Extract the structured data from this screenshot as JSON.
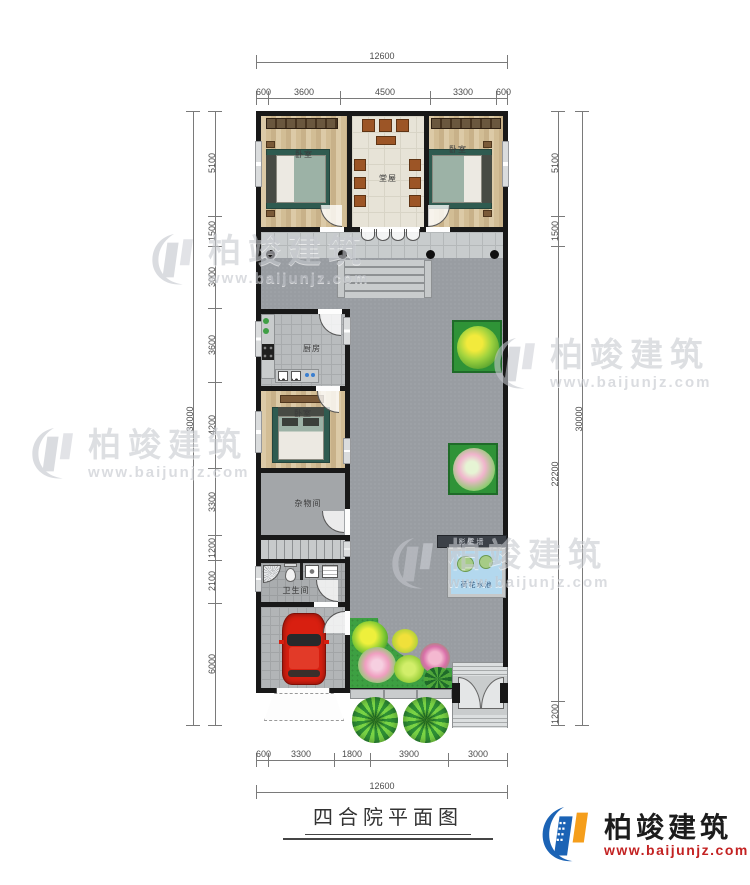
{
  "title": "四合院平面图",
  "brand": {
    "name": "柏竣建筑",
    "url": "www.baijunjz.com"
  },
  "watermark": {
    "name": "柏竣建筑",
    "url": "www.baijunjz.com"
  },
  "rooms": {
    "bedroom_top_left": "卧室",
    "hall": "堂屋",
    "bedroom_top_right": "卧室",
    "kitchen": "厨房",
    "bedroom_west": "卧室",
    "storage": "杂物间",
    "bathroom": "卫生间",
    "screen_wall": "影壁墙",
    "lotus_pond": "荷花水池"
  },
  "dimensions": {
    "top": {
      "overall": "12600",
      "segments": [
        "600",
        "3600",
        "4500",
        "3300",
        "600"
      ]
    },
    "bottom": {
      "overall": "12600",
      "segments": [
        "600",
        "3300",
        "1800",
        "3900",
        "3000"
      ]
    },
    "left": {
      "overall": "30000",
      "segments": [
        "5100",
        "1500",
        "3000",
        "3600",
        "4200",
        "3300",
        "1200",
        "2100",
        "6000"
      ]
    },
    "right": {
      "overall": "30000",
      "segments": [
        "5100",
        "1500",
        "22200",
        "1200"
      ]
    }
  },
  "colors": {
    "wall": "#181818",
    "courtyard": "#999da2",
    "green": "#3da042",
    "pond_water": "#b3d8ee",
    "car": "#d81f10",
    "logo_blue": "#1b63b5",
    "logo_orange": "#f59e1b",
    "url_red": "#c32222"
  }
}
